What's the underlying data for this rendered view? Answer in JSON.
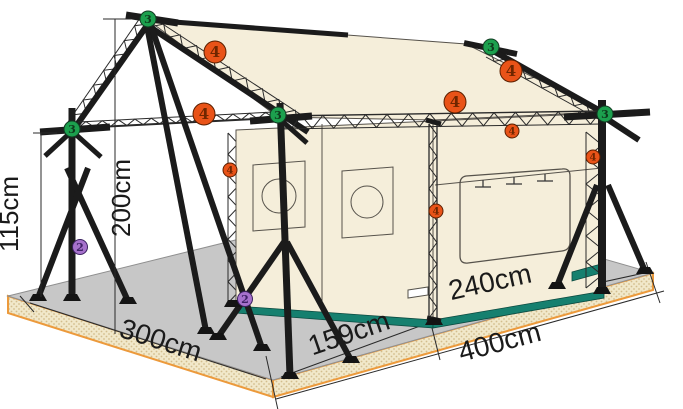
{
  "diagram": {
    "kind": "tent-frame-assembly-diagram",
    "dimension_labels": {
      "left_height": "115cm",
      "apex_height": "200cm",
      "side_depth": "300cm",
      "front_open_width": "159cm",
      "front_tent_width": "240cm",
      "front_total_width": "400cm"
    },
    "part_markers": {
      "green": "3",
      "orange": "4",
      "purple": "2"
    },
    "colors": {
      "fabric": "#f5eeda",
      "floor_top": "#c7c7c7",
      "floor_side": "#f1e8ca",
      "floor_dot": "#d2bd8d",
      "trim": "#ec9a3c",
      "skirt": "#16806f",
      "frame": "#1b1b1b",
      "wallstroke": "#56524b",
      "text": "#1a1a1a",
      "green": "#1ca04e",
      "green_digit": "#0e3a1c",
      "orange": "#e95318",
      "orange_digit": "#6f2600",
      "purple": "#a671cc",
      "purple_digit": "#3f2168"
    }
  }
}
